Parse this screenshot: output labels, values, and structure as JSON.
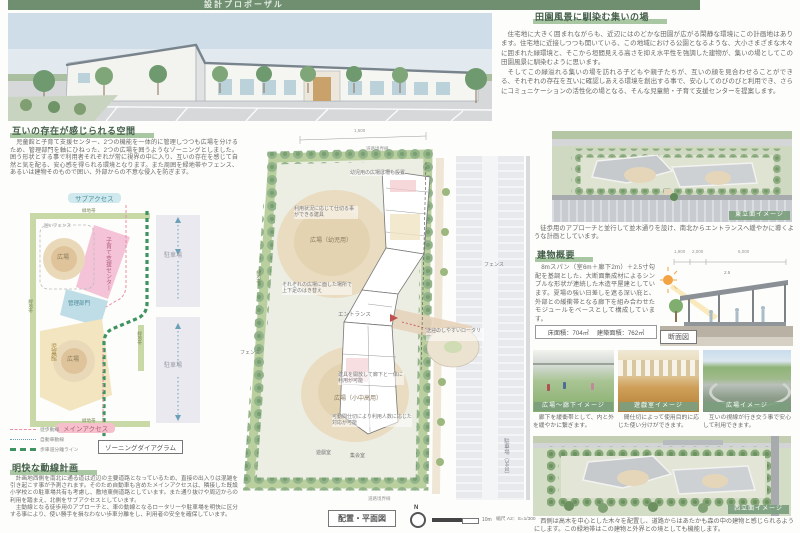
{
  "banner": {
    "title": "設計プロポーザル"
  },
  "mutual": {
    "heading": "互いの存在が感じられる空間",
    "body": "児童館と子育て支援センター、2つの機能を一体的に管理しつつも広場を分けるため、管理部門を軸にひねった、2つの広場を囲うようなゾーニングとしました。囲う形状とする事で利用者それぞれが常に視界の中に入り、互いの存在を感じて自然と気を配る、安心感を得られる環境となります。また周囲を緑地帯やフェンス、あるいは建物そのもので囲い、外部からの不意な侵入を防ぎます。"
  },
  "zoning": {
    "sub_access": "サブアクセス",
    "main_access": "メインアクセス",
    "greenbelt": "緑地帯",
    "fence_note": "囲いフェンス",
    "support_center": "子育て支援センター",
    "admin": "管理部門",
    "jidokan": "児童館",
    "plaza": "広場",
    "parking": "駐車場",
    "legend": [
      "徒歩動線",
      "自動車動線",
      "歩車道分離ライン"
    ],
    "caption": "ゾーニングダイアグラム"
  },
  "circulation": {
    "heading": "明快な動線計画",
    "p1": "計画地西側を南北に通る道は近辺の主要道路となっているため、直接の出入りは混雑を引き起こす事が予測されます。そのため自動車も含めたメインアクセスは、隣接した既設小学校との駐車場共有も考慮し、敷地東側道路としています。また通り抜けや周辺からの利用を踏まえ、北側をサブアクセスとしています。",
    "p2": "主動線となる徒歩用のアプローチと、車の動線となるロータリーや駐車場を明快に区分する事により、使い勝手を損なわない歩車分離をし、利用者の安全を確保しています。"
  },
  "rural": {
    "heading": "田園風景に馴染む集いの場",
    "p1": "住宅地に大きく囲まれながらも、近辺にはのどかな田園が広がる閑静な環境にこの計画地はあります。住宅地に近接しつつも開いている、この地域における公園となるような、大小さまざまな木々に囲まれた緑環境と、そこから垣間見える高さを抑え水平性を強調した建物が、集いの場としてこの田園風景に馴染むように思います。",
    "p2": "そしてこの緑溢れる集いの場を訪れる子どもや親子たちが、互いの顔を見合わせることができる、それぞれの存在を互いに確認しあえる環境を創出する事で、安心してのびのびと利用でき、さらにコミュニケーションの活性化の場となる、そんな児童館・子育て支援センターを提案します。"
  },
  "aerial_east": {
    "tag": "東立面イメージ",
    "caption": "徒歩用のアプローチと並行して並木通りを設け、南北からエントランスへ緩やかに導くような計画としています。"
  },
  "building": {
    "heading": "建物概要",
    "body": "8mスパン（室6m＋廊下2m）＋2.5寸勾配を基調とした、大断面集成材によるシンプルな形状が連続した木造平屋建としています。夏場の強い日差しを遮る深い庇と、外部との緩衝帯となる廊下を組み合わせたモジュールをベースとして構成しています。",
    "floor_area": "床面積：704㎡",
    "building_area": "建築面積：762㎡",
    "section_label": "断面図",
    "dims": [
      "1,900",
      "2,000",
      "6,000"
    ],
    "slope": "2.5"
  },
  "photos": [
    {
      "tag": "広場～廊下イメージ",
      "caption": "廊下を緩衝帯として、内と外を緩やかに繋ぎます。"
    },
    {
      "tag": "遊戯室イメージ",
      "caption": "間仕切によって使用目的に応じた使い分けができます。"
    },
    {
      "tag": "広場イメージ",
      "caption": "互いの視線が行き交う事で安心して利用できます。"
    }
  ],
  "aerial_west": {
    "tag": "西立面イメージ",
    "caption": "西側は高木を中心とした木々を配置し、道路からはあたかも森の中の建物と感じられるようにします。この緑地帯はこの建物と外界との境としても機能します。"
  },
  "plan": {
    "caption": "配置・平面図",
    "north": "N",
    "scale_len": "10m",
    "scale": "縮尺 A2：S=1/300",
    "dim_top": "1,500",
    "boundary": "道路境界線",
    "greenbelt": "緑地帯",
    "ann_fence_top": "幼児用の広場は柵も設置",
    "ann_partition": "利用状況に応じて仕切る事ができる建具",
    "plaza_infant": "広場（幼児用）",
    "ann_shoes": "それぞれの広場に面した場所で上下足のはき替え",
    "entrance": "エントランス",
    "rotary": "送迎のしやすいロータリー",
    "ann_open": "建具を開放して廊下と一体に利用が可能",
    "plaza_elder": "広場（小中高用）",
    "ann_movable": "可動間仕切により利用人数に応じた対応が可能",
    "room_play": "遊戯室",
    "room_meeting": "集会室",
    "fence": "フェンス",
    "parking": "駐車場（34台）"
  }
}
